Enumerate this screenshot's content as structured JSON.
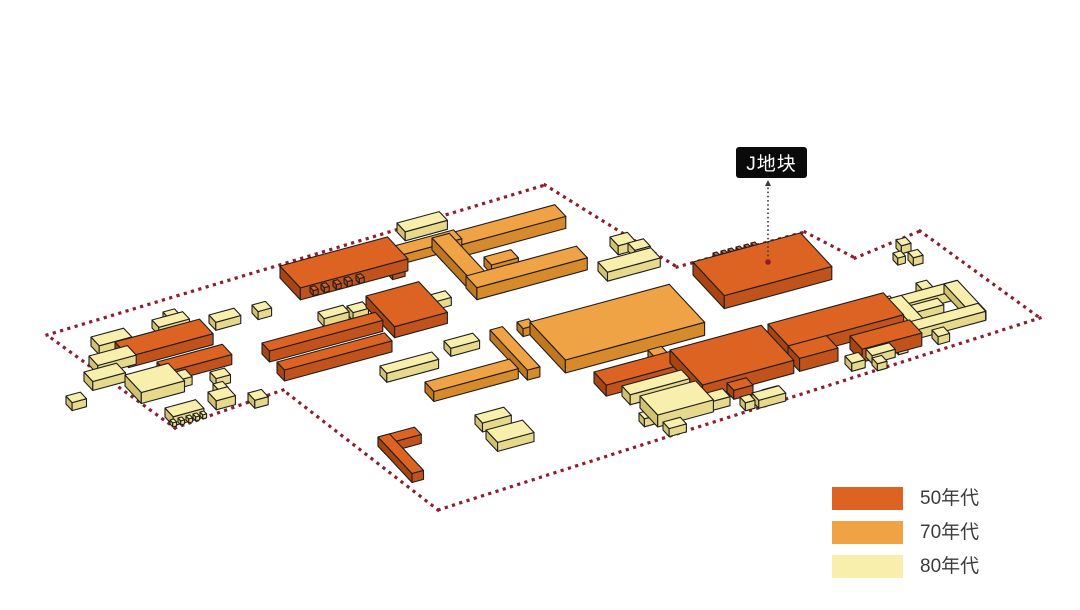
{
  "annotation": {
    "label_text": "J地块"
  },
  "legend": {
    "items": [
      {
        "era": "50",
        "label": "50年代"
      },
      {
        "era": "70",
        "label": "70年代"
      },
      {
        "era": "80",
        "label": "80年代"
      }
    ]
  },
  "palette": {
    "eras": {
      "50": {
        "top": "#dc6322",
        "front": "#c1521c",
        "left": "#a84510"
      },
      "70": {
        "top": "#f0a344",
        "front": "#d78a2b",
        "left": "#c1771f"
      },
      "80": {
        "top": "#f8efad",
        "front": "#e7d98c",
        "left": "#d2c170"
      }
    },
    "outline": "#1e1e1e",
    "boundary": "#8d1e2d",
    "leader": "#3a3a3a",
    "leader_anchor": "#8c1c2b",
    "label_bg": "#0a0a0a",
    "label_fg": "#ffffff",
    "legend_text": "#3c3c3c"
  },
  "diagram": {
    "projection": {
      "ex": [
        0.96,
        -0.26
      ],
      "ey": [
        0.68,
        0.73
      ]
    },
    "boundary": [
      [
        47,
        335
      ],
      [
        545,
        185
      ],
      [
        677,
        267
      ],
      [
        805,
        232
      ],
      [
        855,
        258
      ],
      [
        920,
        231
      ],
      [
        1040,
        318
      ],
      [
        438,
        510
      ],
      [
        283,
        390
      ],
      [
        175,
        428
      ],
      [
        47,
        335
      ]
    ],
    "label_leader": {
      "x": 768,
      "y1": 184,
      "y2": 257,
      "anchor_y": 262
    },
    "buildings": [
      {
        "era": "80",
        "x": 91,
        "y": 337,
        "l": 34,
        "w": 12,
        "h": 9
      },
      {
        "era": "80",
        "x": 84,
        "y": 372,
        "l": 34,
        "w": 13,
        "h": 9
      },
      {
        "era": "80",
        "x": 66,
        "y": 396,
        "l": 15,
        "w": 9,
        "h": 8
      },
      {
        "era": "80",
        "x": 89,
        "y": 356,
        "l": 40,
        "w": 13,
        "h": 9
      },
      {
        "era": "50",
        "x": 115,
        "y": 342,
        "l": 88,
        "w": 20,
        "h": 11
      },
      {
        "era": "50",
        "x": 157,
        "y": 362,
        "l": 68,
        "w": 14,
        "h": 10
      },
      {
        "era": "80",
        "x": 125,
        "y": 375,
        "l": 45,
        "w": 24,
        "h": 11
      },
      {
        "era": "80",
        "x": 165,
        "y": 408,
        "l": 32,
        "w": 12,
        "h": 9
      },
      {
        "era": "80",
        "x": 170,
        "y": 420,
        "l": 4,
        "w": 4,
        "h": 4,
        "z": 1
      },
      {
        "era": "80",
        "x": 178,
        "y": 418,
        "l": 4,
        "w": 4,
        "h": 4,
        "z": 1
      },
      {
        "era": "80",
        "x": 186,
        "y": 416,
        "l": 4,
        "w": 4,
        "h": 4,
        "z": 1
      },
      {
        "era": "80",
        "x": 193,
        "y": 414,
        "l": 4,
        "w": 4,
        "h": 4,
        "z": 1
      },
      {
        "era": "80",
        "x": 200,
        "y": 412,
        "l": 4,
        "w": 4,
        "h": 4,
        "z": 1
      },
      {
        "era": "80",
        "x": 152,
        "y": 320,
        "l": 32,
        "w": 10,
        "h": 8
      },
      {
        "era": "80",
        "x": 163,
        "y": 312,
        "l": 12,
        "w": 9,
        "h": 7
      },
      {
        "era": "80",
        "x": 209,
        "y": 315,
        "l": 26,
        "w": 10,
        "h": 8
      },
      {
        "era": "80",
        "x": 252,
        "y": 305,
        "l": 14,
        "w": 9,
        "h": 8
      },
      {
        "era": "80",
        "x": 208,
        "y": 392,
        "l": 20,
        "w": 12,
        "h": 9
      },
      {
        "era": "80",
        "x": 213,
        "y": 384,
        "l": 10,
        "w": 8,
        "h": 7
      },
      {
        "era": "80",
        "x": 168,
        "y": 374,
        "l": 18,
        "w": 10,
        "h": 8
      },
      {
        "era": "80",
        "x": 210,
        "y": 372,
        "l": 15,
        "w": 9,
        "h": 8
      },
      {
        "era": "80",
        "x": 248,
        "y": 393,
        "l": 14,
        "w": 10,
        "h": 8
      },
      {
        "era": "50",
        "x": 280,
        "y": 266,
        "l": 112,
        "w": 30,
        "h": 12
      },
      {
        "era": "50",
        "x": 310,
        "y": 287,
        "l": 5,
        "w": 5,
        "h": 5,
        "z": 1
      },
      {
        "era": "50",
        "x": 321,
        "y": 284,
        "l": 5,
        "w": 5,
        "h": 5,
        "z": 1
      },
      {
        "era": "50",
        "x": 333,
        "y": 281,
        "l": 5,
        "w": 5,
        "h": 5,
        "z": 1
      },
      {
        "era": "50",
        "x": 344,
        "y": 278,
        "l": 5,
        "w": 5,
        "h": 5,
        "z": 1
      },
      {
        "era": "50",
        "x": 356,
        "y": 275,
        "l": 5,
        "w": 5,
        "h": 5,
        "z": 1
      },
      {
        "era": "70",
        "x": 372,
        "y": 252,
        "l": 85,
        "w": 12,
        "h": 9
      },
      {
        "era": "50",
        "x": 379,
        "y": 257,
        "l": 13,
        "w": 20,
        "h": 8
      },
      {
        "era": "80",
        "x": 397,
        "y": 223,
        "l": 44,
        "w": 12,
        "h": 9
      },
      {
        "era": "80",
        "x": 318,
        "y": 312,
        "l": 26,
        "w": 9,
        "h": 8
      },
      {
        "era": "80",
        "x": 347,
        "y": 306,
        "l": 16,
        "w": 9,
        "h": 8
      },
      {
        "era": "50",
        "x": 262,
        "y": 343,
        "l": 118,
        "w": 11,
        "h": 11
      },
      {
        "era": "50",
        "x": 277,
        "y": 362,
        "l": 112,
        "w": 11,
        "h": 11
      },
      {
        "era": "50",
        "x": 366,
        "y": 296,
        "l": 55,
        "w": 42,
        "h": 11
      },
      {
        "era": "80",
        "x": 380,
        "y": 366,
        "l": 54,
        "w": 10,
        "h": 9
      },
      {
        "era": "70",
        "x": 425,
        "y": 382,
        "l": 88,
        "w": 13,
        "h": 10
      },
      {
        "era": "80",
        "x": 444,
        "y": 341,
        "l": 30,
        "w": 10,
        "h": 8
      },
      {
        "era": "80",
        "x": 426,
        "y": 296,
        "l": 20,
        "w": 9,
        "h": 8
      },
      {
        "era": "70",
        "x": 432,
        "y": 238,
        "l": 128,
        "w": 16,
        "h": 12
      },
      {
        "era": "70",
        "x": 432,
        "y": 238,
        "l": 18,
        "w": 66,
        "h": 12
      },
      {
        "era": "70",
        "x": 466,
        "y": 276,
        "l": 115,
        "w": 16,
        "h": 12
      },
      {
        "era": "70",
        "x": 484,
        "y": 257,
        "l": 28,
        "w": 11,
        "h": 9
      },
      {
        "era": "70",
        "x": 490,
        "y": 330,
        "l": 13,
        "w": 55,
        "h": 10
      },
      {
        "era": "70",
        "x": 517,
        "y": 322,
        "l": 12,
        "w": 9,
        "h": 8
      },
      {
        "era": "70",
        "x": 530,
        "y": 322,
        "l": 145,
        "w": 52,
        "h": 13
      },
      {
        "era": "70",
        "x": 648,
        "y": 350,
        "l": 14,
        "w": 24,
        "h": 10
      },
      {
        "era": "80",
        "x": 598,
        "y": 262,
        "l": 55,
        "w": 14,
        "h": 9
      },
      {
        "era": "80",
        "x": 610,
        "y": 237,
        "l": 18,
        "w": 12,
        "h": 9
      },
      {
        "era": "80",
        "x": 628,
        "y": 243,
        "l": 16,
        "w": 10,
        "h": 8
      },
      {
        "era": "50",
        "x": 693,
        "y": 262,
        "l": 112,
        "w": 46,
        "h": 13
      },
      {
        "era": "50",
        "x": 713,
        "y": 253,
        "l": 4,
        "w": 4,
        "h": 4
      },
      {
        "era": "50",
        "x": 721,
        "y": 251,
        "l": 4,
        "w": 4,
        "h": 4
      },
      {
        "era": "50",
        "x": 728,
        "y": 249,
        "l": 4,
        "w": 4,
        "h": 4
      },
      {
        "era": "50",
        "x": 736,
        "y": 247,
        "l": 4,
        "w": 4,
        "h": 4
      },
      {
        "era": "50",
        "x": 744,
        "y": 245,
        "l": 4,
        "w": 4,
        "h": 4
      },
      {
        "era": "50",
        "x": 751,
        "y": 243,
        "l": 4,
        "w": 4,
        "h": 4
      },
      {
        "era": "50",
        "x": 594,
        "y": 372,
        "l": 90,
        "w": 18,
        "h": 11
      },
      {
        "era": "50",
        "x": 670,
        "y": 350,
        "l": 95,
        "w": 48,
        "h": 13
      },
      {
        "era": "50",
        "x": 727,
        "y": 383,
        "l": 20,
        "w": 10,
        "h": 9
      },
      {
        "era": "80",
        "x": 622,
        "y": 386,
        "l": 62,
        "w": 12,
        "h": 10
      },
      {
        "era": "80",
        "x": 640,
        "y": 396,
        "l": 58,
        "w": 26,
        "h": 12
      },
      {
        "era": "80",
        "x": 688,
        "y": 398,
        "l": 36,
        "w": 11,
        "h": 9
      },
      {
        "era": "80",
        "x": 639,
        "y": 413,
        "l": 10,
        "w": 8,
        "h": 8
      },
      {
        "era": "80",
        "x": 663,
        "y": 422,
        "l": 18,
        "w": 9,
        "h": 8
      },
      {
        "era": "80",
        "x": 740,
        "y": 397,
        "l": 10,
        "w": 8,
        "h": 8
      },
      {
        "era": "80",
        "x": 752,
        "y": 393,
        "l": 28,
        "w": 10,
        "h": 8
      },
      {
        "era": "50",
        "x": 768,
        "y": 324,
        "l": 120,
        "w": 30,
        "h": 13
      },
      {
        "era": "50",
        "x": 788,
        "y": 346,
        "l": 40,
        "w": 17,
        "h": 13
      },
      {
        "era": "50",
        "x": 850,
        "y": 336,
        "l": 62,
        "w": 18,
        "h": 13
      },
      {
        "era": "80",
        "x": 845,
        "y": 356,
        "l": 14,
        "w": 10,
        "h": 8
      },
      {
        "era": "80",
        "x": 866,
        "y": 349,
        "l": 24,
        "w": 9,
        "h": 8
      },
      {
        "era": "80",
        "x": 872,
        "y": 358,
        "l": 10,
        "w": 8,
        "h": 7
      },
      {
        "era": "80",
        "x": 893,
        "y": 342,
        "l": 10,
        "w": 8,
        "h": 7
      },
      {
        "era": "80",
        "x": 762,
        "y": 390,
        "l": 16,
        "w": 8,
        "h": 8
      },
      {
        "era": "80",
        "x": 888,
        "y": 299,
        "l": 72,
        "w": 11,
        "h": 9
      },
      {
        "era": "80",
        "x": 888,
        "y": 299,
        "l": 14,
        "w": 42,
        "h": 9
      },
      {
        "era": "80",
        "x": 909,
        "y": 322,
        "l": 72,
        "w": 11,
        "h": 9
      },
      {
        "era": "80",
        "x": 944,
        "y": 284,
        "l": 14,
        "w": 42,
        "h": 9
      },
      {
        "era": "80",
        "x": 905,
        "y": 307,
        "l": 34,
        "w": 9,
        "h": 8
      },
      {
        "era": "80",
        "x": 916,
        "y": 283,
        "l": 11,
        "w": 12,
        "h": 8
      },
      {
        "era": "80",
        "x": 932,
        "y": 330,
        "l": 12,
        "w": 9,
        "h": 8
      },
      {
        "era": "80",
        "x": 882,
        "y": 298,
        "l": 8,
        "w": 8,
        "h": 7
      },
      {
        "era": "80",
        "x": 884,
        "y": 311,
        "l": 8,
        "w": 8,
        "h": 7
      },
      {
        "era": "80",
        "x": 896,
        "y": 240,
        "l": 10,
        "w": 8,
        "h": 8
      },
      {
        "era": "80",
        "x": 908,
        "y": 252,
        "l": 10,
        "w": 8,
        "h": 8
      },
      {
        "era": "80",
        "x": 893,
        "y": 253,
        "l": 8,
        "w": 7,
        "h": 7
      },
      {
        "era": "50",
        "x": 378,
        "y": 437,
        "l": 38,
        "w": 10,
        "h": 9
      },
      {
        "era": "50",
        "x": 378,
        "y": 437,
        "l": 12,
        "w": 50,
        "h": 9
      },
      {
        "era": "80",
        "x": 475,
        "y": 415,
        "l": 30,
        "w": 11,
        "h": 9
      },
      {
        "era": "80",
        "x": 486,
        "y": 430,
        "l": 38,
        "w": 17,
        "h": 9
      }
    ]
  }
}
